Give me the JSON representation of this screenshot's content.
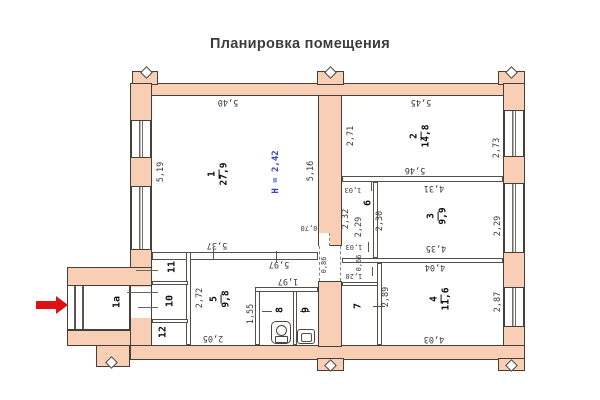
{
  "title": "Планировка помещения",
  "colors": {
    "wall_fill": "#f8ceb4",
    "wall_outline": "#453f3a",
    "height_label": "#3240cf",
    "entrance_label": "#e04848",
    "entrance_arrow": "#dd1111"
  },
  "rooms": {
    "1": {
      "num": "1",
      "area": "27,9"
    },
    "2": {
      "num": "2",
      "area": "14,8"
    },
    "3": {
      "num": "3",
      "area": "9,9"
    },
    "4": {
      "num": "4",
      "area": "11,6"
    },
    "5": {
      "num": "5",
      "area": "9,8"
    },
    "6": {
      "num": "6"
    },
    "7": {
      "num": "7"
    },
    "8": {
      "num": "8"
    },
    "9": {
      "num": "9"
    },
    "10": {
      "num": "10"
    },
    "11": {
      "num": "11"
    },
    "12": {
      "num": "12"
    },
    "1a": {
      "num": "1а"
    }
  },
  "dims": {
    "height": "Н = 2,42",
    "room1_top": "5,40",
    "room1_left": "5,19",
    "room1_right": "5,16",
    "room2_top": "5,45",
    "room2_left": "2,71",
    "room2_right": "2,73",
    "room2_bottom": "5,46",
    "room3_top": "4,31",
    "room3_left": "2,30",
    "room3_right": "2,29",
    "room3_bottom": "4,35",
    "corridor_top": "1,03",
    "corridor_left": "2,32",
    "corridor_right": "2,29",
    "corridor_bottom": "1,03",
    "door_room1": "0,70",
    "passage": "0,86",
    "vest_door": "0,66",
    "vest_len": "1,28",
    "room4_top": "4,04",
    "room4_left": "2,89",
    "room4_right": "2,87",
    "room4_bottom": "4,03",
    "hall_top": "5,37",
    "hall_bottom": "5,97",
    "bath_top": "1,97",
    "bath_left": "1,55",
    "room5_left": "2,72",
    "room5_bottom": "2,05"
  },
  "icons": {
    "entrance_arrow": "red-arrow-right",
    "toilet": "toilet-plan-icon",
    "sink": "sink-plan-icon"
  }
}
